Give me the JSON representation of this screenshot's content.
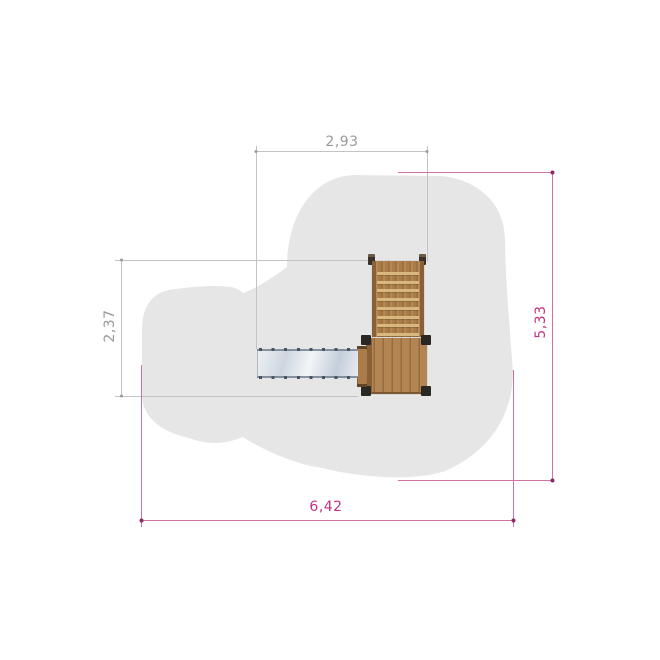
{
  "drawing": {
    "name": "playground-structure-plan-view",
    "dimension_labels": {
      "top": "2,93",
      "left": "2,37",
      "right": "5,33",
      "bottom": "6,42"
    },
    "colors": {
      "background": "#ffffff",
      "safety_zone": "#e7e6e7",
      "dimension_gray_line": "#c3c3c3",
      "dimension_gray_text": "#9a9a9a",
      "dimension_magenta_line": "#d073a4",
      "dimension_magenta_text": "#c13381",
      "dimension_magenta_dot": "#8e2a63",
      "wood": "#ab7c46",
      "wood_dark": "#8a6137",
      "ladder_rung": "#d9b87f",
      "slide_metal": "#cdd6e0",
      "slide_rivet": "#4a5360",
      "corner_post": "#2b2723"
    },
    "structure": {
      "ladder": {
        "rung_count": 8
      },
      "slide": {
        "rivet_rows": 2
      }
    }
  }
}
